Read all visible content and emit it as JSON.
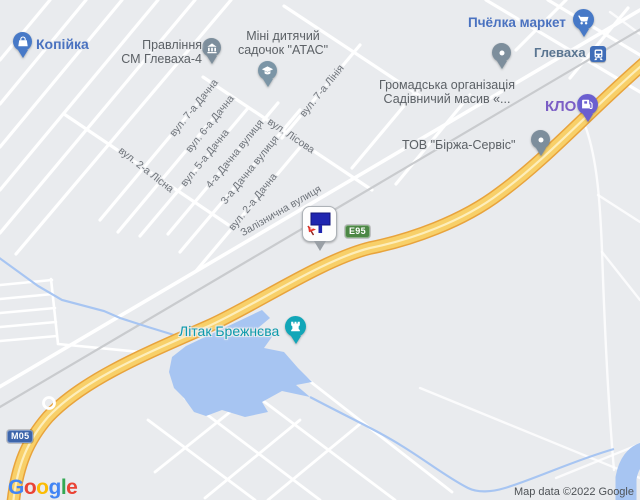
{
  "map": {
    "attribution": "Map data ©2022 Google",
    "colors": {
      "land": "#e9ebee",
      "road": "#ffffff",
      "highway_fill": "#f8d069",
      "highway_casing": "#e8a33c",
      "highway_stripe": "#fdeebb",
      "water": "#a7c5f2",
      "railway": "#c9cbce",
      "street_label": "#6e737a",
      "poi_gray": "#5c6166",
      "poi_blue": "#4a72c0",
      "pin_blue": "#4779c7",
      "pin_slate": "#7d8e9c",
      "pin_school": "#7b95a6",
      "station_blue": "#3f6db8",
      "station_label": "#5a7591",
      "pin_purple": "#6b5fd0",
      "klo_label": "#7b5ec5",
      "pin_teal": "#12a6b8",
      "teal_label": "#0d9aac",
      "e95_green": "#4c8745",
      "m05_blue": "#3d65ab"
    },
    "badges": [
      {
        "label": "E95"
      },
      {
        "label": "M05"
      }
    ],
    "pois": [
      {
        "label": "Копійка",
        "icon": "shopping-bag"
      },
      {
        "label": "Правління",
        "label2": "СМ Глеваха-4",
        "icon": "bank"
      },
      {
        "label": "Міні дитячий",
        "label2": "садочок \"АТАС\"",
        "icon": "graduation-cap"
      },
      {
        "label": "Пчёлка маркет",
        "icon": "shopping-cart"
      },
      {
        "label": "Глеваха",
        "icon": "train-station"
      },
      {
        "label": "Громадська організація",
        "label2": "Садівничий масив «...",
        "icon": "generic-dot"
      },
      {
        "label": "КЛО",
        "icon": "fuel-pump"
      },
      {
        "label": "ТОВ \"Біржа-Сервіс\"",
        "icon": "generic-dot"
      },
      {
        "label": "Літак Брежнєва",
        "icon": "castle"
      }
    ],
    "streets": [
      {
        "name": "вул. 2-а Лісна"
      },
      {
        "name": "вул. 7-а Дачна"
      },
      {
        "name": "вул. 6-а Дачна"
      },
      {
        "name": "вул. 5-а Дачна"
      },
      {
        "name": "4-а Дачна вулиця"
      },
      {
        "name": "3-а Дачна вулиця"
      },
      {
        "name": "вул. 2-а Дачна"
      },
      {
        "name": "Залізнична вулиця"
      },
      {
        "name": "вул. Лісова"
      },
      {
        "name": "вул. 7-а Лінія"
      }
    ],
    "logo": {
      "letters": [
        {
          "ch": "G",
          "color": "#4285F4"
        },
        {
          "ch": "o",
          "color": "#EA4335"
        },
        {
          "ch": "o",
          "color": "#FBBC05"
        },
        {
          "ch": "g",
          "color": "#4285F4"
        },
        {
          "ch": "l",
          "color": "#34A853"
        },
        {
          "ch": "e",
          "color": "#EA4335"
        }
      ]
    }
  }
}
